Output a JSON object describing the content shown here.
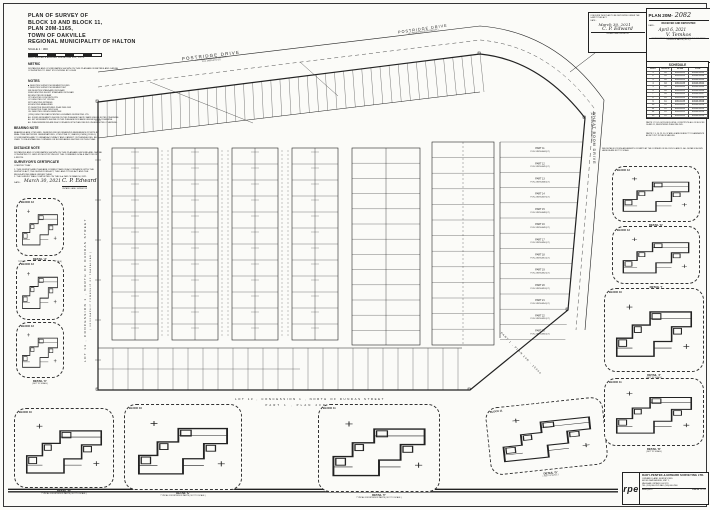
{
  "sheet": {
    "paper": "#fbfbf8",
    "ink": "#1c1c1c"
  },
  "title_block": {
    "lines": [
      "PLAN OF SURVEY OF",
      "BLOCK 10 AND BLOCK 11,",
      "PLAN 20M-1165,",
      "TOWN OF OAKVILLE",
      "REGIONAL MUNICIPALITY OF HALTON"
    ],
    "scale": "SCALE 1 : 300",
    "firm": "RADY-PENTEK & EDWARD SURVEYING LTD., O.L.S.",
    "metric_heading": "METRIC",
    "metric_text": "DISTANCES AND COORDINATES SHOWN ON THIS PLAN ARE IN METRES AND CAN BE CONVERTED TO FEET BY DIVIDING BY 0.3048"
  },
  "notes": {
    "heading": "NOTES",
    "lines": [
      "■   DENOTES SURVEY MONUMENT FOUND",
      "□   DENOTES SURVEY MONUMENT SET",
      "SIB  DENOTES STANDARD IRON BAR",
      "SSIB DENOTES SHORT STANDARD IRON BAR",
      "IB   DENOTES IRON BAR",
      "CP   DENOTES CONCRETE PIN",
      "CC   DENOTES CUT CROSS",
      "WIT  DENOTES WITNESS",
      "M    DENOTES MEASURED",
      "P1   DENOTES REGISTERED PLAN 20M-1165",
      "P2   DENOTES PLAN 20R-15040",
      "OU   DENOTES ORIGIN UNKNOWN",
      "(1254) DENOTES RADY-PENTEK & EDWARD SURVEYING LTD."
    ],
    "footnotes": [
      "ALL FOUND MONUMENTS SHOWN ON THIS PLAN ARE PLASTIC BARS UNLESS NOTED OTHERWISE.",
      "ALL SET MONUMENTS SHOWN ON THIS PLAN ARE IRON BARS UNLESS NOTED OTHERWISE.",
      "ALL PLAN DIMENSIONS ARE IN ACCORDANCE WITH PLAN 20M-1165 UNLESS NOTED OTHERWISE."
    ]
  },
  "bearing_note": {
    "heading": "BEARING NOTE",
    "text": "BEARINGS ARE UTM GRID, DERIVED FROM OBSERVED REFERENCE POINTS BY REAL TIME NETWORK OBSERVATIONS, UTM ZONE 17, NAD83 (CSRS) (2010.0). COORDINATES ARE TO URBAN ACCURACY AND CANNOT, IN THEMSELVES, BE USED TO RE-ESTABLISH CORNERS OR BOUNDARIES SHOWN ON THIS PLAN."
  },
  "distance_note": {
    "heading": "DISTANCE NOTE",
    "text": "DISTANCES AND COORDINATES SHOWN ON THIS PLAN ARE GROUND AND CAN BE CONVERTED TO GRID BY MULTIPLYING BY THE COMBINED SCALE FACTOR OF 0.999724."
  },
  "certificate": {
    "heading": "SURVEYOR'S CERTIFICATE",
    "intro": "I CERTIFY THAT :",
    "items": [
      "1. THIS SURVEY AND PLAN ARE CORRECT AND IN ACCORDANCE WITH THE SURVEYS ACT, THE SURVEYORS ACT, THE LAND TITLES ACT AND THE REGULATIONS MADE UNDER THEM.",
      "2. THE SURVEY WAS COMPLETED ON THE 2nd DAY OF MARCH, 2021."
    ],
    "date_label": "DATE :",
    "date_value": "March 30, 2021",
    "signature": "C. P. Edward",
    "signer_title": "ONTARIO LAND SURVEYOR"
  },
  "streets": {
    "postridge": "POSTRIDGE DRIVE",
    "postridge_sub": "( BY REGISTERED PLAN 20M-1165 )",
    "postridge_pin": "P.I.N. 24929-0771 (LT)",
    "wheat_boom": "WHEAT BOOM DRIVE",
    "wheat_boom_sub": "( BY REGISTERED PLAN 20M-1165 )"
  },
  "margins": {
    "west": "LOT  13 ,   CONCESSION  1 ,   NORTH  OF  DUNDAS  STREET",
    "west_sub": "( GEOGRAPHIC  TOWNSHIP  OF  TRAFALGAR )",
    "south_line1": "LOT  13 ,   CONCESSION  1 ,   NORTH  OF  DUNDAS  STREET",
    "south_line2": "PART  1 ,   PLAN   20R - 15040",
    "southeast_angled": "PART 1 ,  PLAN 20R - 15040"
  },
  "deposit_box": {
    "line1": "I REQUIRE THIS PLAN TO BE DEPOSITED UNDER THE LAND TITLES ACT.",
    "date_label": "DATE :",
    "date_value": "March 30, 2021",
    "signature": "C. P. Edward",
    "signer_title": "ONTARIO LAND SURVEYOR"
  },
  "plan_box": {
    "plan_label": "PLAN 20M-",
    "plan_number": "2082",
    "received": "RECEIVED AND DEPOSITED",
    "date_label": "DATE :",
    "date_value": "April 6, 2021",
    "signature": "V. Temkos",
    "signer_title": "REPRESENTATIVE FOR THE LAND REGISTRAR FOR THE LAND TITLES DIVISION OF HALTON ( No. 20 )"
  },
  "schedule": {
    "title": "SCHEDULE",
    "headers": [
      "PART",
      "BLOCK",
      "PLAN",
      "P.I.N."
    ],
    "rows": [
      [
        "1",
        "10",
        "20M-1165",
        "24929-0841"
      ],
      [
        "2",
        "10",
        "20M-1165",
        "24929-0842"
      ],
      [
        "3",
        "10",
        "20M-1165",
        "24929-0843"
      ],
      [
        "4",
        "10",
        "20M-1165",
        "24929-0844"
      ],
      [
        "5",
        "10",
        "20M-1165",
        "24929-0845"
      ],
      [
        "6",
        "10",
        "20M-1165",
        "24929-0846"
      ],
      [
        "7",
        "10",
        "20M-1165",
        "24929-0847"
      ],
      [
        "8",
        "11",
        "20M-1165",
        "24929-0848"
      ],
      [
        "9",
        "11",
        "20M-1165",
        "24929-0849"
      ],
      [
        "10",
        "11",
        "20M-1165",
        "24929-0850"
      ],
      [
        "11",
        "11",
        "20M-1165",
        "24929-0851"
      ],
      [
        "12",
        "11",
        "20M-1165",
        "24929-0852"
      ],
      [
        "13",
        "11",
        "20M-1165",
        "24929-0853"
      ]
    ]
  },
  "right_notes": {
    "p1": "PARTS 1 TO 45, BOTH INCLUSIVE, CONSTITUTE ALL OF BLOCKS 10 AND 11, REGISTERED PLAN 20M-1165.",
    "p2": "PARTS 2, 9, 16, 23, 30, 37 AND 44 ARE SUBJECT TO EASEMENTS AS SET OUT IN THE SCHEDULE.",
    "p3": "SEE DETAILS FOR ENLARGEMENTS OF PARTS AT THE CORNERS OF BLOCKS 10 AND 11. ALL DETAILS SHOWN HEREON ARE NOT TO SCALE."
  },
  "right_lots": {
    "rows": [
      {
        "part": "PART 11",
        "pin": "P.I.N. 24929-0844 (LT)"
      },
      {
        "part": "PART 12",
        "pin": "P.I.N. 24929-0845 (LT)"
      },
      {
        "part": "PART 13",
        "pin": "P.I.N. 24929-0846 (LT)"
      },
      {
        "part": "PART 14",
        "pin": "P.I.N. 24929-0847 (LT)"
      },
      {
        "part": "PART 15",
        "pin": "P.I.N. 24929-0848 (LT)"
      },
      {
        "part": "PART 16",
        "pin": "P.I.N. 24929-0849 (LT)"
      },
      {
        "part": "PART 17",
        "pin": "P.I.N. 24929-0850 (LT)"
      },
      {
        "part": "PART 18",
        "pin": "P.I.N. 24929-0851 (LT)"
      },
      {
        "part": "PART 19",
        "pin": "P.I.N. 24929-0852 (LT)"
      },
      {
        "part": "PART 20",
        "pin": "P.I.N. 24929-0853 (LT)"
      },
      {
        "part": "PART 21",
        "pin": "P.I.N. 24929-0854 (LT)"
      },
      {
        "part": "PART 22",
        "pin": "P.I.N. 24929-0855 (LT)"
      },
      {
        "part": "PART 23",
        "pin": "P.I.N. 24929-0856 (LT)"
      }
    ]
  },
  "details": [
    {
      "block": "BLOCK 13",
      "caption": "DETAIL 'A'",
      "sub": "TYPICAL FOR CORNER PARTS",
      "nts": "( NOT TO SCALE )"
    },
    {
      "block": "BLOCK 13",
      "caption": "DETAIL 'B'",
      "sub": "",
      "nts": "( NOT TO SCALE )"
    },
    {
      "block": "BLOCK 13",
      "caption": "DETAIL 'C'",
      "sub": "",
      "nts": "( NOT TO SCALE )"
    },
    {
      "block": "BLOCK 10",
      "caption": "DETAIL 'D'",
      "sub": "TYPICAL FOR INTERIOR PARTS",
      "nts": "( NOT TO SCALE )"
    },
    {
      "block": "BLOCK 10",
      "caption": "DETAIL 'E'",
      "sub": "TYPICAL FOR INTERIOR PARTS",
      "nts": "( NOT TO SCALE )"
    },
    {
      "block": "BLOCK 11",
      "caption": "DETAIL 'F'",
      "sub": "TYPICAL FOR INTERIOR PARTS",
      "nts": "( NOT TO SCALE )"
    },
    {
      "block": "BLOCK 11",
      "caption": "DETAIL 'G'",
      "sub": "",
      "nts": "( NOT TO SCALE )"
    },
    {
      "block": "BLOCK 13",
      "caption": "DETAIL 'H'",
      "sub": "",
      "nts": "( NOT TO SCALE )"
    },
    {
      "block": "BLOCK 13",
      "caption": "DETAIL 'I'",
      "sub": "",
      "nts": "( NOT TO SCALE )"
    },
    {
      "block": "BLOCK 10",
      "caption": "DETAIL 'J'",
      "sub": "",
      "nts": "( NOT TO SCALE )"
    },
    {
      "block": "BLOCK 11",
      "caption": "DETAIL 'K'",
      "sub": "",
      "nts": "( NOT TO SCALE )"
    }
  ],
  "company": {
    "logo": "rpe",
    "name": "RADY-PENTEK & EDWARD SURVEYING LTD.",
    "subtitle": "ONTARIO LAND SURVEYORS",
    "address1": "665 MILLWAY AVENUE, UNIT 1,",
    "address2": "VAUGHAN, ONTARIO  L4K 3T8",
    "phone": "TEL: (905) 660-7676    FAX: (905) 660-7660",
    "web": "www.r-pe.ca",
    "job_label": "JOB No.",
    "job_value": "20-135"
  }
}
